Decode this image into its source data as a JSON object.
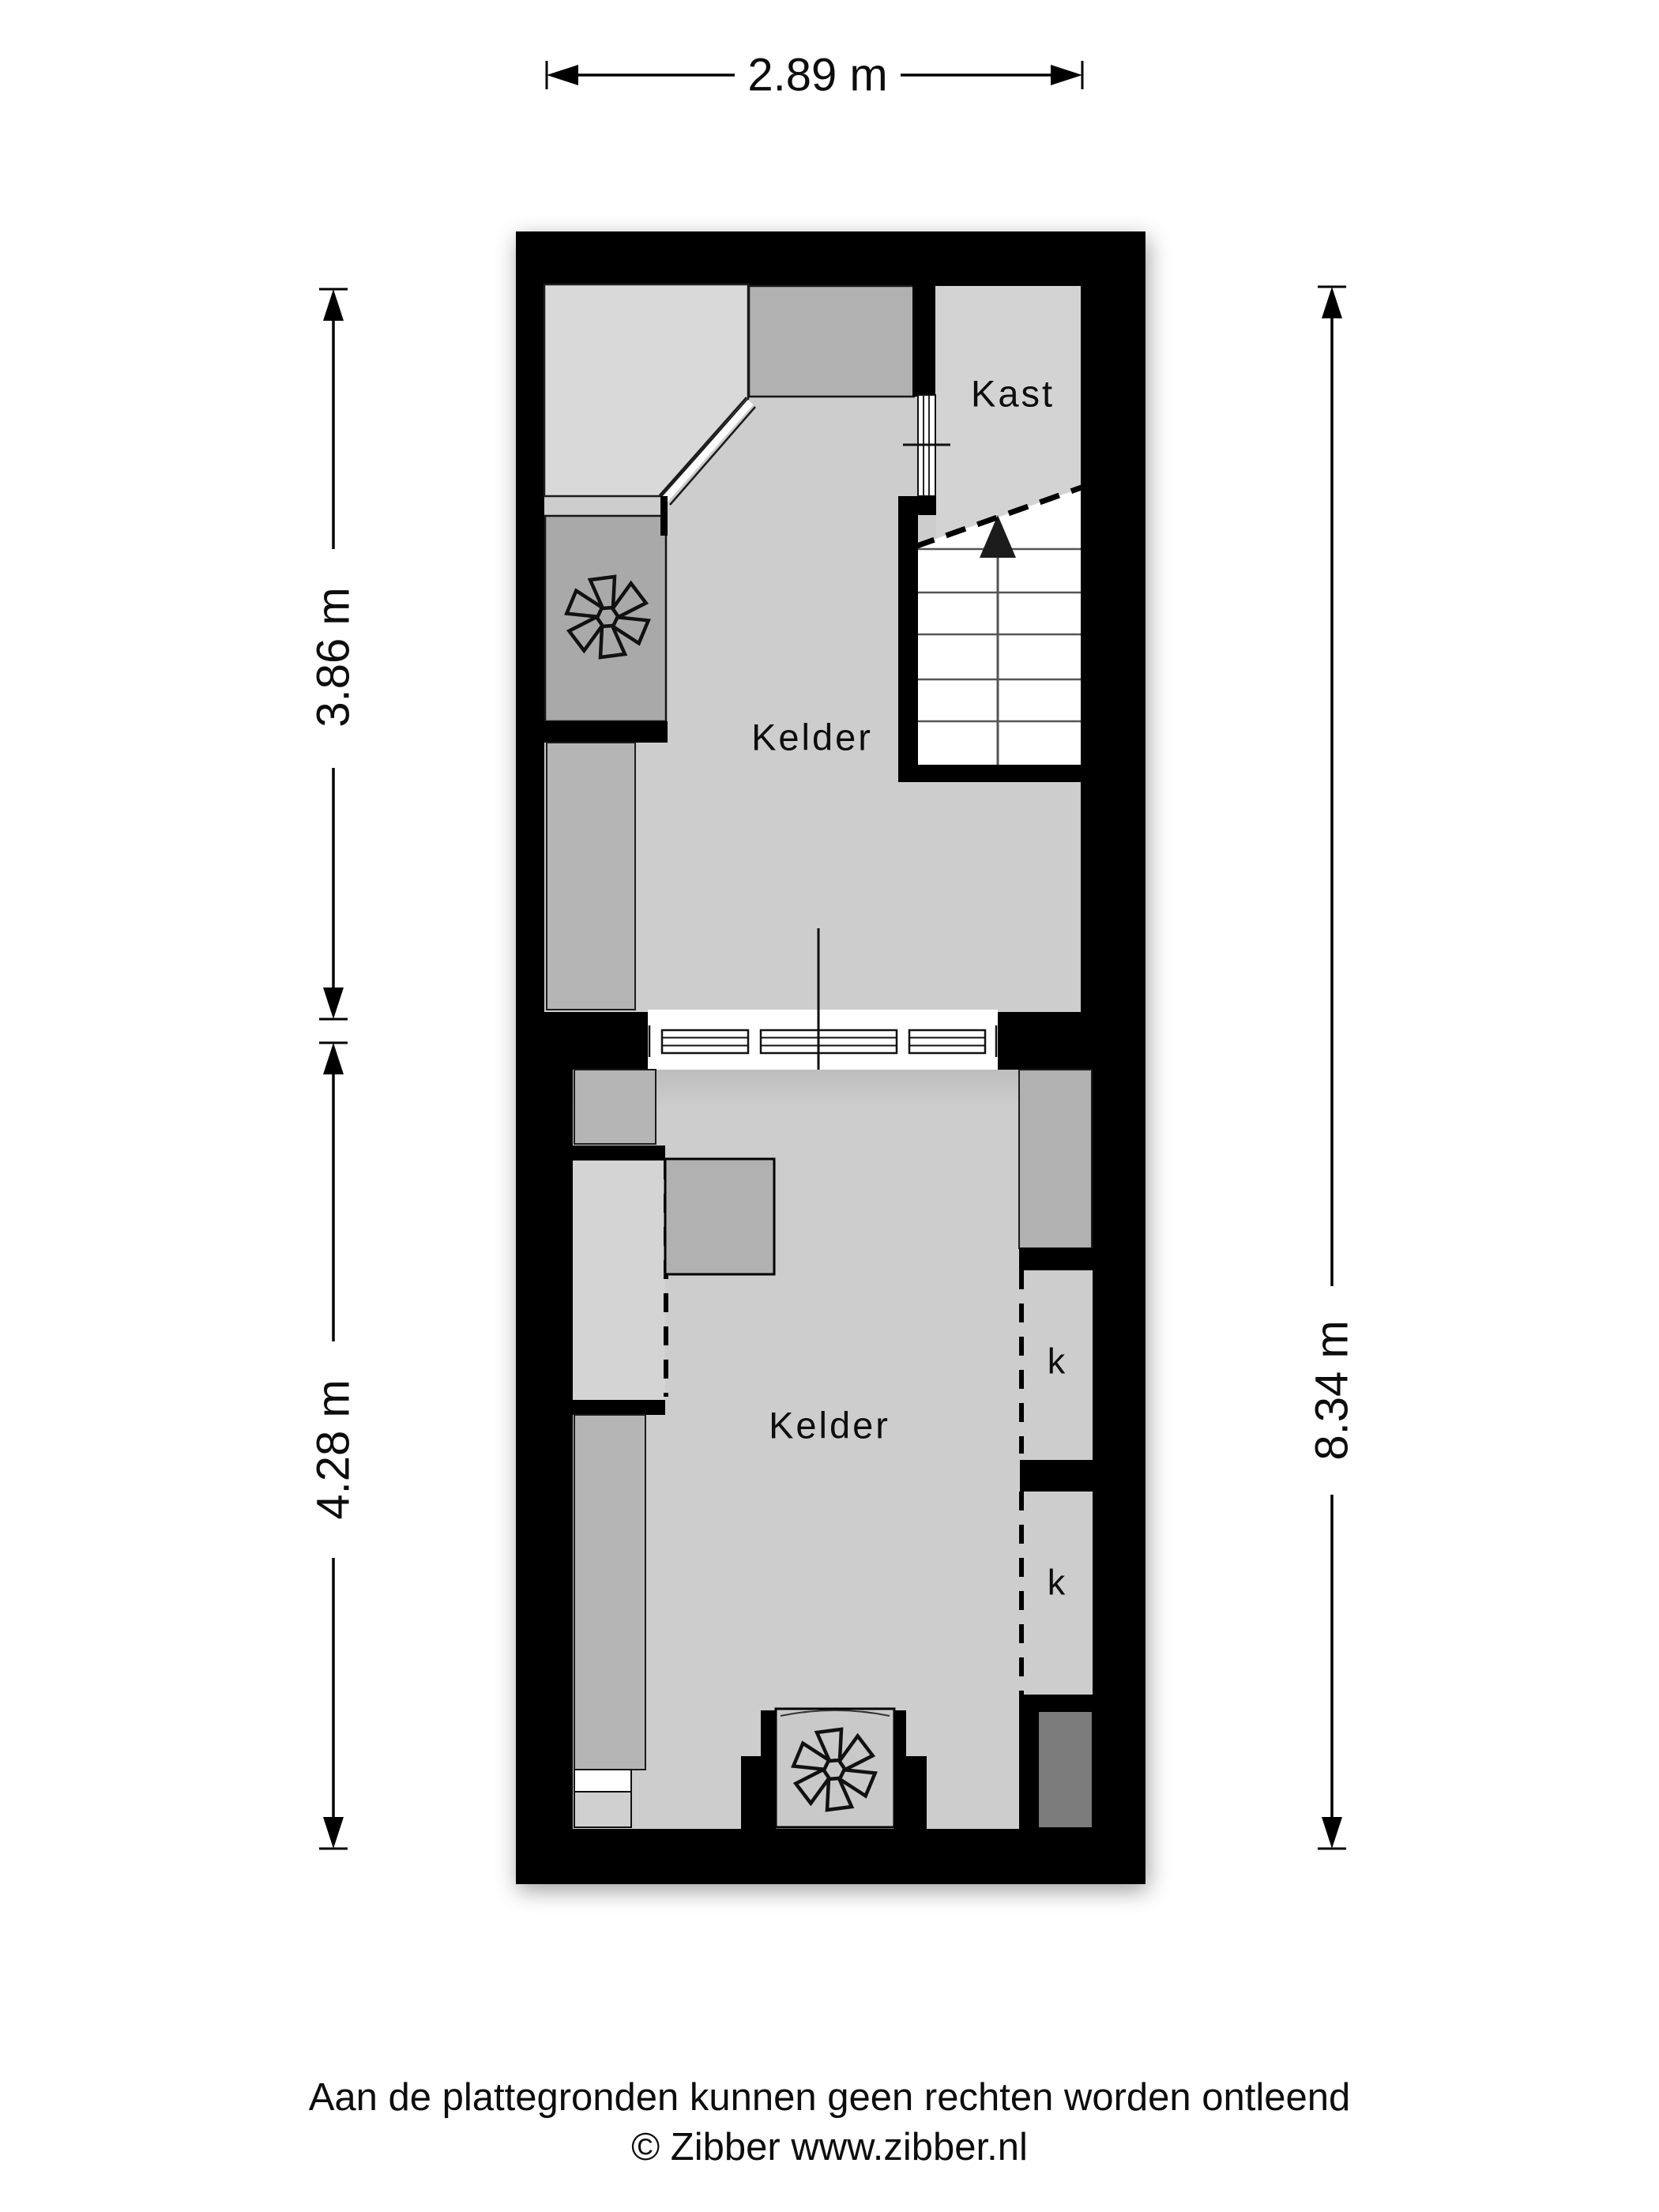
{
  "page": {
    "background": "#ffffff"
  },
  "rooms": {
    "kelder_upper": "Kelder",
    "kast": "Kast",
    "kelder_lower": "Kelder",
    "closet_1": "k",
    "closet_2": "k"
  },
  "dimensions": {
    "top_width": "2.89 m",
    "upper_section_height": "3.86 m",
    "lower_section_height": "4.28 m",
    "total_height": "8.34 m"
  },
  "footer": {
    "disclaimer": "Aan de plattegronden kunnen geen rechten worden ontleend",
    "credit": "© Zibber www.zibber.nl"
  },
  "icons": {
    "fan_upper": "fan-icon",
    "fan_lower": "fan-icon",
    "stairs_arrow": "arrow-up-icon"
  },
  "colors": {
    "wall": "#000000",
    "floor_main": "#cdcdcd",
    "floor_light": "#d9d9d9",
    "floor_kast": "#d3d3d3",
    "unit_dark": "#a9a9a9",
    "unit_medium": "#b1b1b1",
    "column": "#b5b5b5",
    "shaft": "#7b7b7b",
    "niche": "#c9c9c9",
    "background": "#ffffff"
  }
}
